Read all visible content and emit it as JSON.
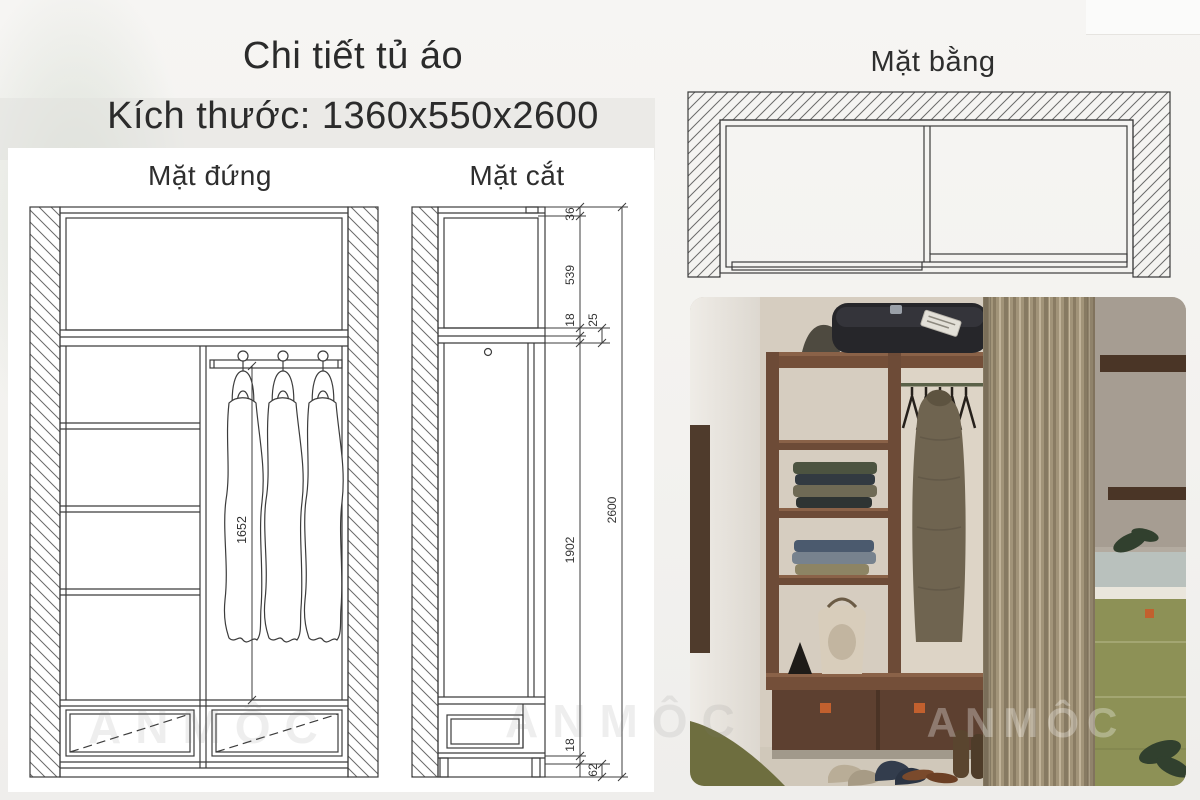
{
  "page": {
    "title": "Chi tiết tủ áo",
    "subtitle": "Kích thước: 1360x550x2600"
  },
  "views": {
    "elevation_label": "Mặt đứng",
    "section_label": "Mặt cắt",
    "plan_label": "Mặt bằng"
  },
  "dimensions": {
    "hanging_height": "1652",
    "top_rail": "36",
    "upper_compartment": "539",
    "shelf_thickness_top": "18",
    "gap": "25",
    "main_compartment": "1902",
    "shelf_thickness_bottom": "18",
    "base_height": "62",
    "overall_height": "2600"
  },
  "watermark": {
    "brand": "ANMÔC"
  },
  "colors": {
    "line": "#3c3c3c",
    "wood_brown": "#6d4b37",
    "curtain_beige": "#a09176",
    "cabinet_olive": "#8d9156",
    "handle_orange": "#c2602e"
  }
}
